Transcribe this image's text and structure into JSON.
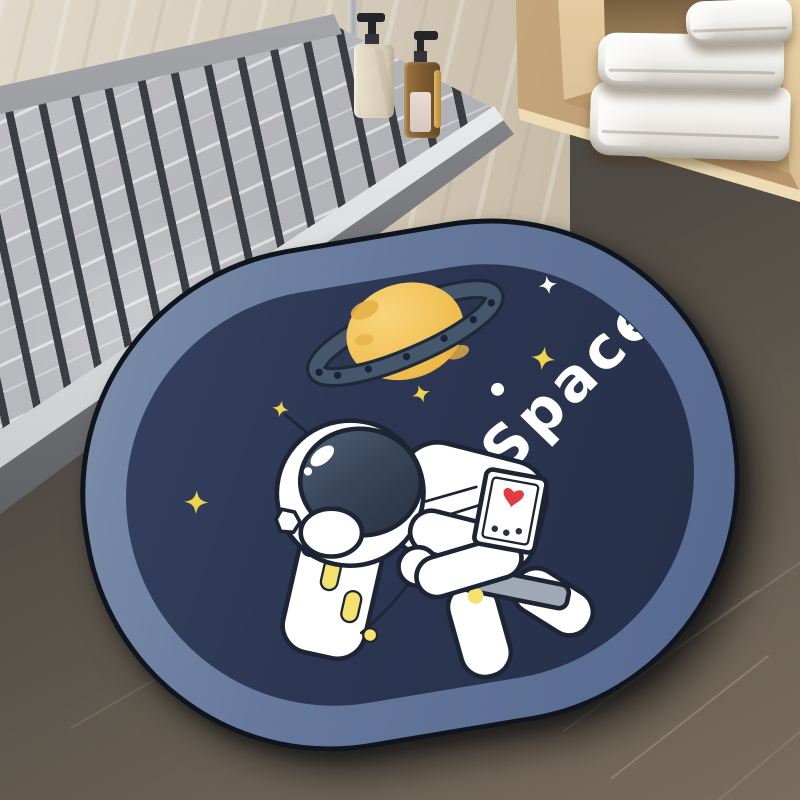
{
  "scene": {
    "mat_text": "Space",
    "towel_count": 3,
    "dispenser_count": 2
  },
  "palette": {
    "mat_border": "#64779b",
    "mat_navy": "#2b3550",
    "mat_edge": "#10141c",
    "planet_yellow": "#f2c45c",
    "planet_shade": "#e7b148",
    "ring_slate": "#46566c",
    "ring_dark": "#1f2937",
    "star_yellow": "#eed34f",
    "suit_white": "#ffffff",
    "outline_dark": "#1d2433",
    "visor_dark": "#3a4658",
    "heart_red": "#e23c42",
    "pill_yellow": "#f3e26d",
    "belt_gray": "#9fa8b4",
    "wood_tan": "#c9ad85",
    "wall_beige": "#d8cfc0",
    "floor_gray": "#4a4845",
    "marble_gray": "#b7b8bc"
  }
}
